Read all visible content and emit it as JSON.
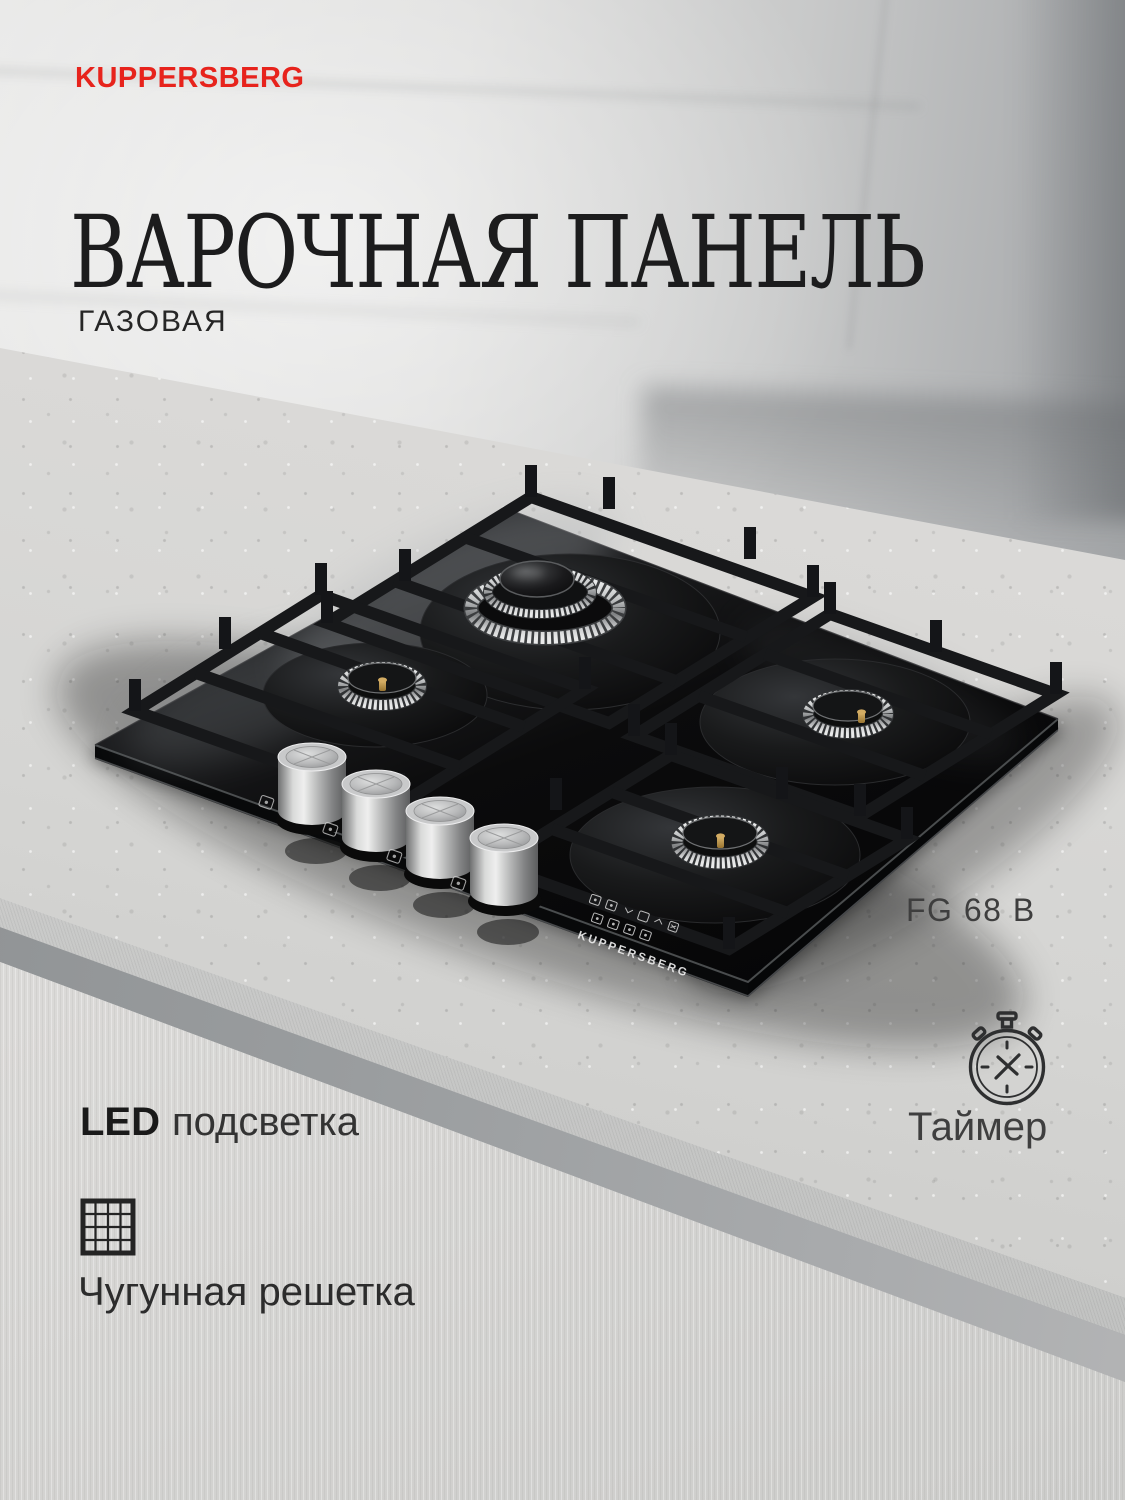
{
  "brand_logo": {
    "text": "KUPPERSBERG",
    "color": "#e7231c"
  },
  "headline": {
    "title": "ВАРОЧНАЯ ПАНЕЛЬ",
    "subtitle": "ГАЗОВАЯ"
  },
  "product": {
    "model": "FG 68 B",
    "glass_print": "KUPPERSBERG",
    "burner_count": 4,
    "control_knob_count": 4
  },
  "features": {
    "led": {
      "prefix": "LED",
      "label": "подсветка"
    },
    "timer": {
      "label": "Таймер",
      "icon": "stopwatch-icon"
    },
    "grate": {
      "label": "Чугунная решетка",
      "icon": "cast-iron-grid-icon"
    }
  },
  "colors": {
    "brand_red": "#e7231c",
    "title_ink": "#1c1c1d",
    "body_ink": "#333333",
    "glass_black": "#0b0b0c",
    "knob_silver": "#c8c9ca",
    "brass": "#c9a35f",
    "counter_gray": "#d5d5d3",
    "wall_gray": "#c8c9c9",
    "cabinet_white": "#dcdbd9"
  }
}
